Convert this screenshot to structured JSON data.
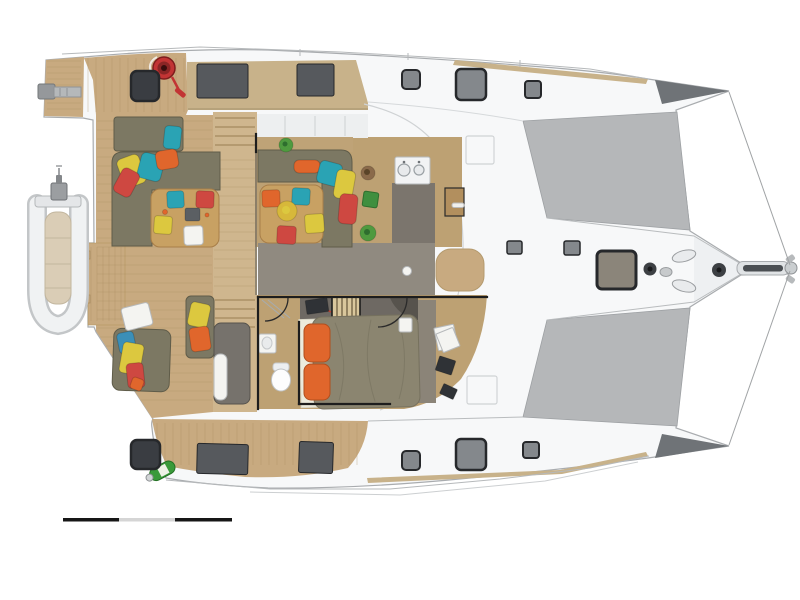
{
  "meta": {
    "document_type": "yacht-deck-interior-plan",
    "orientation": "bow-right",
    "background": "#ffffff"
  },
  "palette": {
    "hull_white": "#f7f8f9",
    "hull_stroke": "#a9acaf",
    "hull_shadow": "#eef0f2",
    "hull_dark": "#6f7377",
    "tramp": "#b5b7b9",
    "tramp_edge": "#9da0a3",
    "teak": "#c8aa80",
    "teak_light": "#cfb68e",
    "teak_band": "#c8b28a",
    "plank": "#a98c60",
    "interior_tan": "#bda173",
    "galley_gray": "#7b756d",
    "corridor_gray": "#908a80",
    "cabin_gray": "#8b8478",
    "sofa": "#7c7863",
    "sofa_dark": "#5f5c49",
    "table_wood": "#c8a163",
    "table_edge": "#a87e48",
    "wall": "#1d1d1d",
    "window_dark": "#56595d",
    "hatch_dark": "#3a3d42",
    "hatch_gray": "#84888c",
    "hatch_tan": "#8b857a",
    "hatch_frame": "#26282b",
    "orange": "#e0662c",
    "orange_dark": "#b14e1d",
    "red": "#ce4841",
    "teal": "#2aa3b4",
    "blue": "#3b8fb8",
    "yellow": "#dcc83f",
    "fruit": "#d7b83a",
    "green": "#4f9a3f",
    "green_dark": "#3f8f3f",
    "green_edge": "#2e6e2e",
    "pot": "#8a6a4a",
    "pot_dark": "#5a4428",
    "white_item": "#f4f4f1",
    "gray_line": "#b6b9bb",
    "tray": "#5b5f63",
    "duvet": "#8b8570",
    "duvet_line": "#76715e",
    "sheet": "#ecebdd",
    "headboard": "#6e6963",
    "cabinet": "#76726c",
    "device_dark": "#2f3236",
    "winch_red": "#c23434",
    "bottle_green": "#3a9a3a",
    "scale_dark": "#161616",
    "scale_light": "#d5d5d5"
  },
  "scale_bar": {
    "x": 63,
    "y": 518,
    "h": 3.5,
    "segments": [
      {
        "name": "scale-bar-segment-1",
        "w": 56,
        "fill": "scale_dark"
      },
      {
        "name": "scale-bar-segment-2",
        "w": 56,
        "fill": "scale_light"
      },
      {
        "name": "scale-bar-segment-3",
        "w": 57,
        "fill": "scale_dark"
      }
    ]
  },
  "items": {
    "rects": [
      {
        "name": "aft-deck-hatch-port",
        "x": 131,
        "y": 71,
        "w": 28,
        "h": 30,
        "rx": 6,
        "fill": "hatch_dark",
        "stroke": "hatch_frame",
        "sw": 2.5
      },
      {
        "name": "aft-deck-hatch-starboard",
        "x": 131,
        "y": 440,
        "w": 29,
        "h": 29,
        "rx": 6,
        "fill": "hatch_dark",
        "stroke": "hatch_frame",
        "sw": 2.5
      },
      {
        "name": "foredeck-hatch-port-aft",
        "x": 402,
        "y": 70,
        "w": 18,
        "h": 19,
        "rx": 4,
        "fill": "hatch_gray",
        "stroke": "hatch_frame",
        "sw": 2
      },
      {
        "name": "foredeck-hatch-port-main",
        "x": 456,
        "y": 69,
        "w": 30,
        "h": 31,
        "rx": 5,
        "fill": "hatch_gray",
        "stroke": "hatch_frame",
        "sw": 2.5
      },
      {
        "name": "foredeck-hatch-port-fwd",
        "x": 525,
        "y": 81,
        "w": 16,
        "h": 17,
        "rx": 3,
        "fill": "hatch_gray",
        "stroke": "hatch_frame",
        "sw": 2
      },
      {
        "name": "foredeck-hatch-starboard-aft",
        "x": 402,
        "y": 451,
        "w": 18,
        "h": 19,
        "rx": 4,
        "fill": "hatch_gray",
        "stroke": "hatch_frame",
        "sw": 2
      },
      {
        "name": "foredeck-hatch-starboard-main",
        "x": 456,
        "y": 439,
        "w": 30,
        "h": 31,
        "rx": 5,
        "fill": "hatch_gray",
        "stroke": "hatch_frame",
        "sw": 2.5
      },
      {
        "name": "foredeck-hatch-starboard-fwd",
        "x": 523,
        "y": 442,
        "w": 16,
        "h": 16,
        "rx": 3,
        "fill": "hatch_gray",
        "stroke": "hatch_frame",
        "sw": 2
      },
      {
        "name": "bow-locker-hatch",
        "x": 597,
        "y": 251,
        "w": 39,
        "h": 38,
        "rx": 5,
        "fill": "hatch_tan",
        "stroke": "hatch_frame",
        "sw": 3
      },
      {
        "name": "bow-hatch-small-port",
        "x": 507,
        "y": 241,
        "w": 15,
        "h": 13,
        "rx": 2,
        "fill": "hatch_gray",
        "stroke": "hatch_frame",
        "sw": 1.5
      },
      {
        "name": "bow-hatch-small-starboard",
        "x": 564,
        "y": 241,
        "w": 16,
        "h": 14,
        "rx": 2,
        "fill": "hatch_gray",
        "stroke": "hatch_frame",
        "sw": 1.5
      },
      {
        "name": "coachroof-window-port-aft",
        "x": 197,
        "y": 64,
        "w": 51,
        "h": 34,
        "rx": 2,
        "fill": "window_dark",
        "stroke": "hatch_frame",
        "sw": 1
      },
      {
        "name": "coachroof-window-port-fwd",
        "x": 297,
        "y": 64,
        "w": 37,
        "h": 32,
        "rx": 2,
        "fill": "window_dark",
        "stroke": "hatch_frame",
        "sw": 1
      },
      {
        "name": "hullside-window-starboard-aft",
        "x": 197,
        "y": 444,
        "w": 51,
        "h": 30,
        "rx": 2,
        "rot": 1.5,
        "fill": "window_dark",
        "stroke": "hatch_frame",
        "sw": 1
      },
      {
        "name": "hullside-window-starboard-fwd",
        "x": 299,
        "y": 442,
        "w": 34,
        "h": 31,
        "rx": 2,
        "rot": 2,
        "fill": "window_dark",
        "stroke": "hatch_frame",
        "sw": 1
      },
      {
        "name": "cockpit-seat-cushion-teal",
        "x": 167,
        "y": 191,
        "w": 17,
        "h": 17,
        "rx": 3,
        "rot": -3,
        "fill": "teal"
      },
      {
        "name": "cockpit-seat-cushion-red",
        "x": 196,
        "y": 191,
        "w": 18,
        "h": 17,
        "rx": 3,
        "rot": 2,
        "fill": "red"
      },
      {
        "name": "cockpit-seat-cushion-yellow",
        "x": 154,
        "y": 216,
        "w": 18,
        "h": 18,
        "rx": 3,
        "rot": 4,
        "fill": "yellow"
      },
      {
        "name": "cockpit-table-plate",
        "x": 184,
        "y": 226,
        "w": 19,
        "h": 19,
        "rx": 3,
        "rot": -2,
        "fill": "white_item",
        "stroke": "gray_line",
        "sw": 1
      },
      {
        "name": "cockpit-table-tray",
        "x": 185,
        "y": 208,
        "w": 15,
        "h": 13,
        "rx": 2,
        "fill": "tray"
      },
      {
        "name": "saloon-seat-cushion-orange",
        "x": 262,
        "y": 190,
        "w": 18,
        "h": 17,
        "rx": 3,
        "rot": -2,
        "fill": "orange"
      },
      {
        "name": "saloon-seat-cushion-teal",
        "x": 292,
        "y": 188,
        "w": 18,
        "h": 17,
        "rx": 3,
        "rot": 3,
        "fill": "teal"
      },
      {
        "name": "saloon-seat-cushion-yellow",
        "x": 305,
        "y": 214,
        "w": 19,
        "h": 19,
        "rx": 3,
        "rot": -4,
        "fill": "yellow"
      },
      {
        "name": "saloon-seat-cushion-red",
        "x": 277,
        "y": 226,
        "w": 19,
        "h": 18,
        "rx": 3,
        "rot": 3,
        "fill": "red"
      },
      {
        "name": "cockpit-sunpad-pillow-teal",
        "x": 164,
        "y": 126,
        "w": 17,
        "h": 23,
        "rx": 4,
        "rot": 6,
        "fill": "teal"
      },
      {
        "name": "cockpit-pillow-yellow",
        "x": 120,
        "y": 156,
        "w": 23,
        "h": 30,
        "rx": 5,
        "rot": -20,
        "fill": "yellow"
      },
      {
        "name": "cockpit-pillow-teal",
        "x": 139,
        "y": 154,
        "w": 24,
        "h": 26,
        "rx": 5,
        "rot": 15,
        "fill": "teal"
      },
      {
        "name": "cockpit-pillow-orange",
        "x": 156,
        "y": 150,
        "w": 22,
        "h": 19,
        "rx": 5,
        "rot": -10,
        "fill": "orange"
      },
      {
        "name": "cockpit-pillow-red",
        "x": 117,
        "y": 169,
        "w": 19,
        "h": 27,
        "rx": 5,
        "rot": 28,
        "fill": "red"
      },
      {
        "name": "saloon-pillow-orange",
        "x": 294,
        "y": 160,
        "w": 26,
        "h": 13,
        "rx": 5,
        "fill": "orange"
      },
      {
        "name": "saloon-pillow-teal",
        "x": 318,
        "y": 162,
        "w": 23,
        "h": 23,
        "rx": 5,
        "rot": 15,
        "fill": "teal"
      },
      {
        "name": "saloon-pillow-yellow",
        "x": 335,
        "y": 170,
        "w": 19,
        "h": 29,
        "rx": 5,
        "rot": 10,
        "fill": "yellow"
      },
      {
        "name": "saloon-pillow-red",
        "x": 339,
        "y": 194,
        "w": 18,
        "h": 30,
        "rx": 5,
        "rot": 5,
        "fill": "red"
      },
      {
        "name": "lounge-pillow-blue",
        "x": 118,
        "y": 332,
        "w": 17,
        "h": 21,
        "rx": 4,
        "rot": -12,
        "fill": "blue"
      },
      {
        "name": "lounge-pillow-yellow",
        "x": 121,
        "y": 343,
        "w": 21,
        "h": 31,
        "rx": 4,
        "rot": 10,
        "fill": "yellow"
      },
      {
        "name": "lounge-pillow-red",
        "x": 127,
        "y": 363,
        "w": 17,
        "h": 25,
        "rx": 4,
        "rot": -6,
        "fill": "red"
      },
      {
        "name": "lounge-pillow-orange",
        "x": 131,
        "y": 378,
        "w": 12,
        "h": 12,
        "rx": 3,
        "rot": 20,
        "fill": "orange"
      },
      {
        "name": "bench-pillow-yellow",
        "x": 189,
        "y": 303,
        "w": 20,
        "h": 24,
        "rx": 4,
        "rot": 12,
        "fill": "yellow"
      },
      {
        "name": "bench-pillow-orange",
        "x": 190,
        "y": 327,
        "w": 20,
        "h": 24,
        "rx": 4,
        "rot": -8,
        "fill": "orange"
      },
      {
        "name": "bed-pillow-orange-upper",
        "x": 304,
        "y": 324,
        "w": 26,
        "h": 38,
        "rx": 7,
        "fill": "orange",
        "stroke": "orange_dark",
        "sw": 1
      },
      {
        "name": "bed-pillow-orange-lower",
        "x": 304,
        "y": 364,
        "w": 26,
        "h": 36,
        "rx": 7,
        "fill": "orange",
        "stroke": "orange_dark",
        "sw": 1
      },
      {
        "name": "sideboard-green-box",
        "x": 363,
        "y": 192,
        "w": 15,
        "h": 15,
        "rx": 2,
        "rot": 8,
        "fill": "green_dark",
        "stroke": "green_edge",
        "sw": 1
      },
      {
        "name": "cabin-laptop",
        "x": 306,
        "y": 299,
        "w": 22,
        "h": 14,
        "rx": 1,
        "rot": -8,
        "fill": "device_dark"
      },
      {
        "name": "desk-tablet",
        "x": 437,
        "y": 358,
        "w": 17,
        "h": 15,
        "rx": 1,
        "rot": 18,
        "fill": "device_dark"
      },
      {
        "name": "desk-small-item",
        "x": 441,
        "y": 386,
        "w": 15,
        "h": 11,
        "rx": 1,
        "rot": 25,
        "fill": "device_dark"
      },
      {
        "name": "lounge-towel",
        "x": 123,
        "y": 305,
        "w": 28,
        "h": 23,
        "rx": 3,
        "rot": -14,
        "fill": "white_item",
        "stroke": "gray_line",
        "sw": 1
      },
      {
        "name": "desk-papers-1",
        "x": 436,
        "y": 326,
        "w": 20,
        "h": 23,
        "rx": 1,
        "rot": -12,
        "fill": "white_item",
        "stroke": "gray_line",
        "sw": 1
      },
      {
        "name": "desk-papers-2",
        "x": 439,
        "y": 330,
        "w": 18,
        "h": 20,
        "rx": 1,
        "rot": -22,
        "fill": "white_item",
        "stroke": "gray_line",
        "sw": 1
      },
      {
        "name": "bedside-switch-panel",
        "x": 399,
        "y": 318,
        "w": 13,
        "h": 14,
        "rx": 2,
        "fill": "white_item",
        "stroke": "gray_line",
        "sw": 1
      },
      {
        "name": "cabinet-white-pad",
        "x": 214,
        "y": 354,
        "w": 13,
        "h": 46,
        "rx": 6,
        "fill": "white_item",
        "stroke": "gray_line",
        "sw": 1
      }
    ],
    "circles": [
      {
        "name": "saloon-plant",
        "cx": 286,
        "cy": 145,
        "r": 7,
        "fill": "green",
        "inner": {
          "r": 2.5,
          "fill": "green_edge"
        }
      },
      {
        "name": "sideboard-pot",
        "cx": 368,
        "cy": 173,
        "r": 7,
        "fill": "pot",
        "inner": {
          "r": 3,
          "fill": "pot_dark"
        }
      },
      {
        "name": "sideboard-plant",
        "cx": 368,
        "cy": 233,
        "r": 8,
        "fill": "green",
        "inner": {
          "r": 3,
          "fill": "green_edge"
        }
      },
      {
        "name": "corridor-deck-light",
        "cx": 407,
        "cy": 271,
        "r": 4.5,
        "fill": "white_item",
        "stroke": "gray_line",
        "sw": 1
      },
      {
        "name": "saloon-table-fruit-bowl",
        "cx": 287,
        "cy": 211,
        "r": 10,
        "fill": "fruit",
        "inner": {
          "r": 4,
          "fill": "yellow"
        }
      },
      {
        "name": "cockpit-table-fruit",
        "cx": 165,
        "cy": 212,
        "r": 2.5,
        "fill": "orange"
      },
      {
        "name": "cockpit-table-item",
        "cx": 207,
        "cy": 215,
        "r": 2,
        "fill": "orange"
      }
    ]
  }
}
